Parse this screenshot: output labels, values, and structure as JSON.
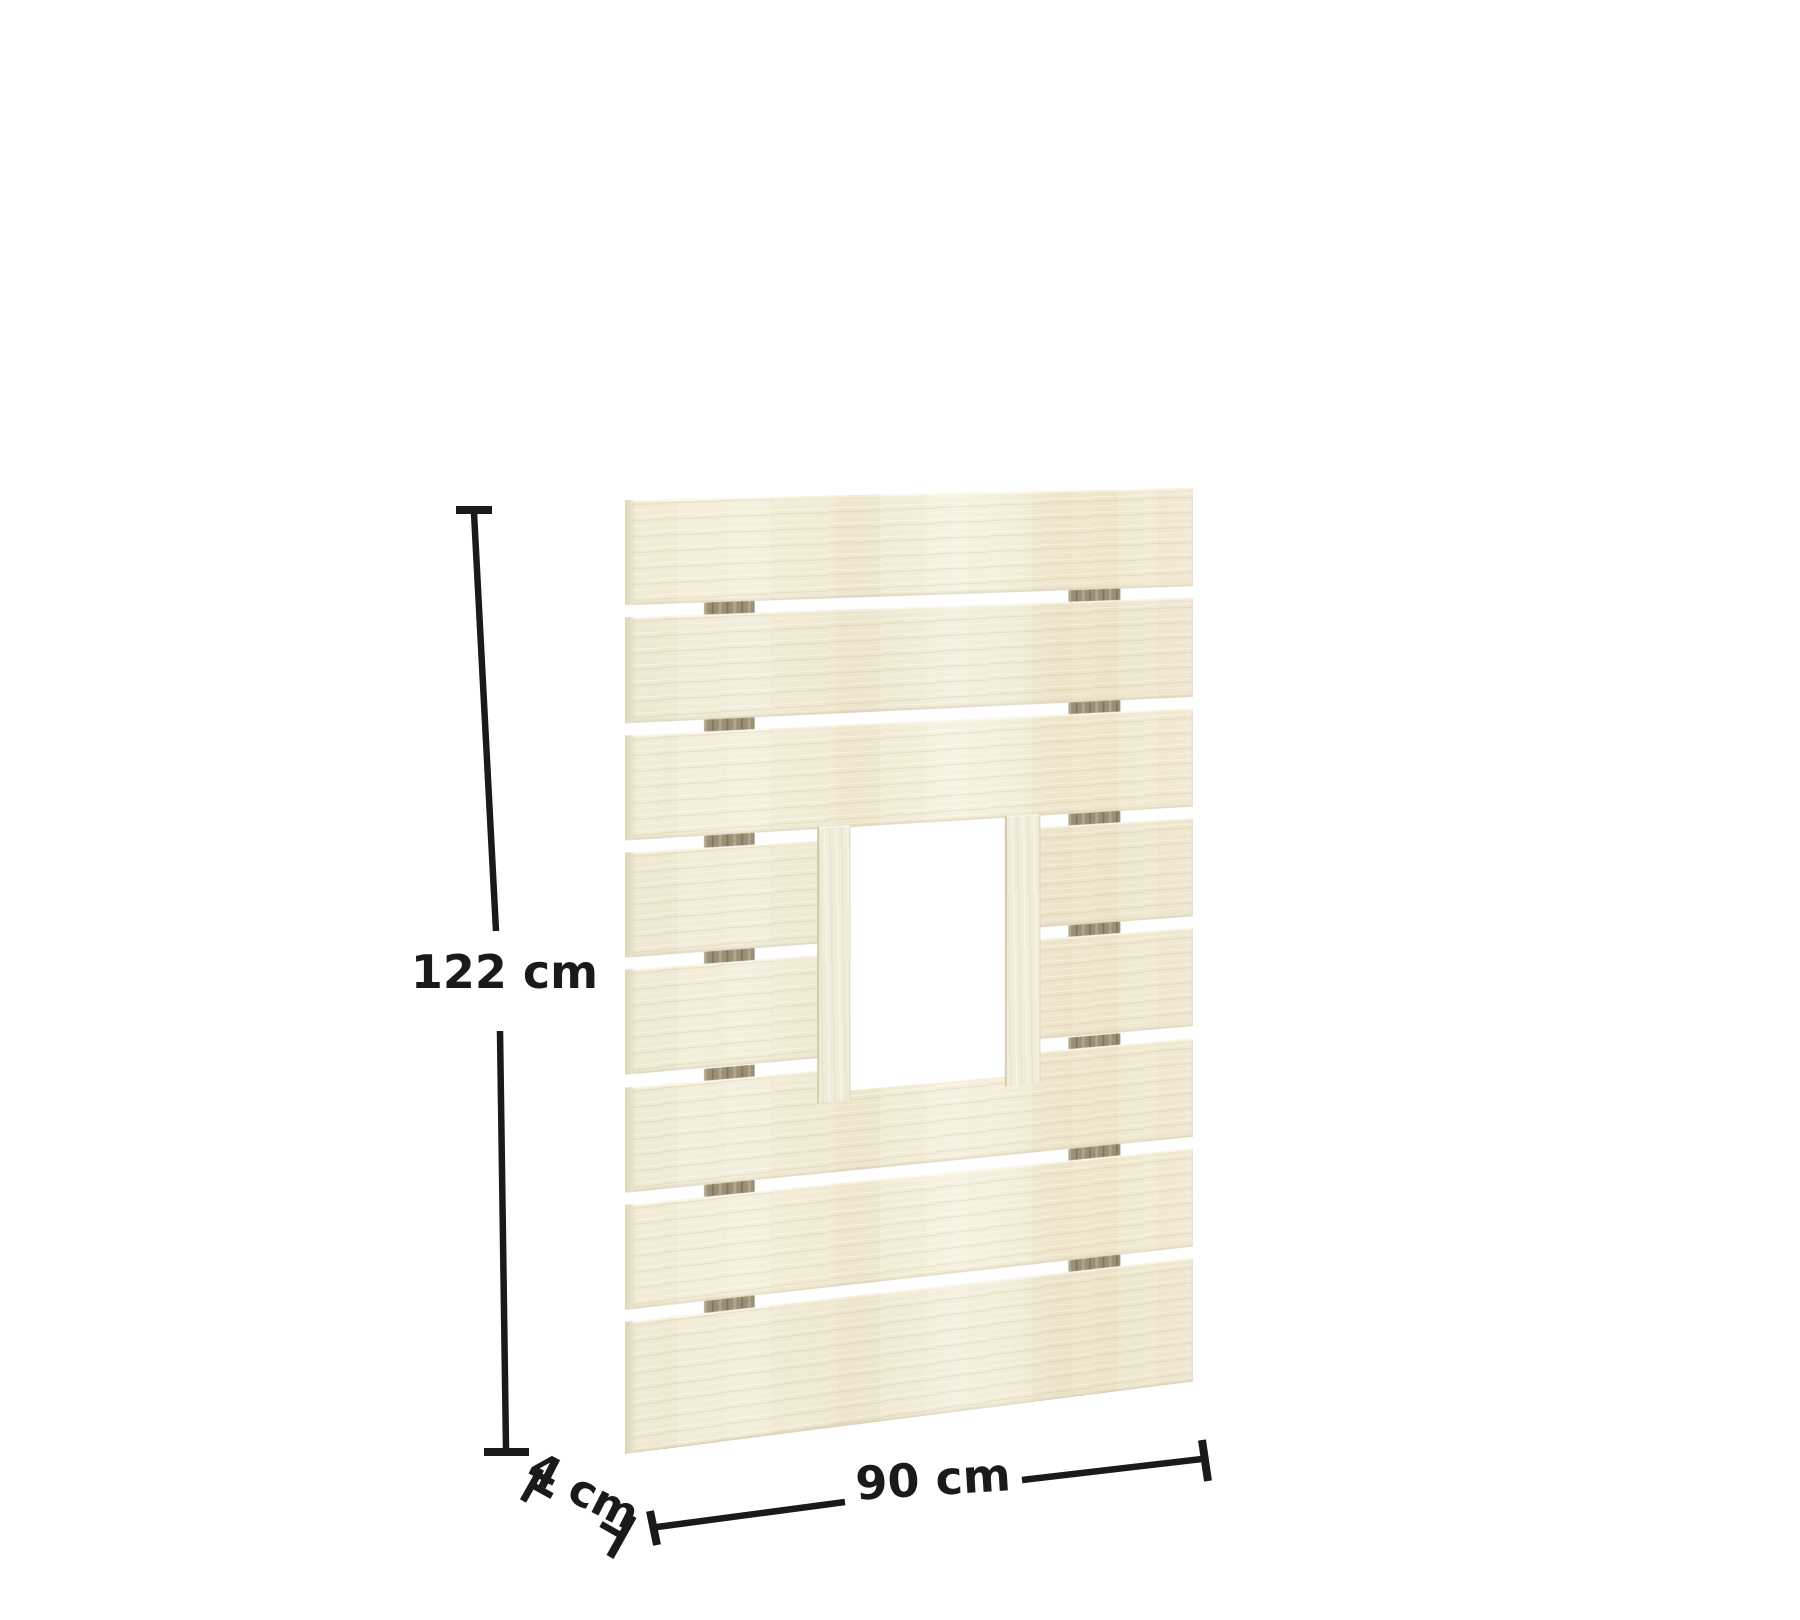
{
  "diagram": {
    "title": "Slatted wooden panel with window opening - dimension drawing",
    "dimensions": {
      "height": {
        "label": "122 cm",
        "value": 122,
        "unit": "cm"
      },
      "width": {
        "label": "90 cm",
        "value": 90,
        "unit": "cm"
      },
      "depth": {
        "label": "4 cm",
        "value": 4,
        "unit": "cm"
      }
    },
    "panel": {
      "slat_count": 8,
      "gap_count": 7,
      "spacer_battens_per_gap": 2,
      "has_window_opening": true,
      "colors": {
        "wood_base": "#f0e9d2",
        "wood_light": "#f4efdc",
        "wood_mid": "#eee6cb",
        "wood_dark": "#ece4c7",
        "jamb_face": "#f1ecd9",
        "edge_face": "#ddd6ba",
        "edge_face_light": "#e9e3c9",
        "spacer": "#9b9075",
        "background": "#ffffff",
        "dimension_ink": "#1a1a1a"
      }
    }
  }
}
